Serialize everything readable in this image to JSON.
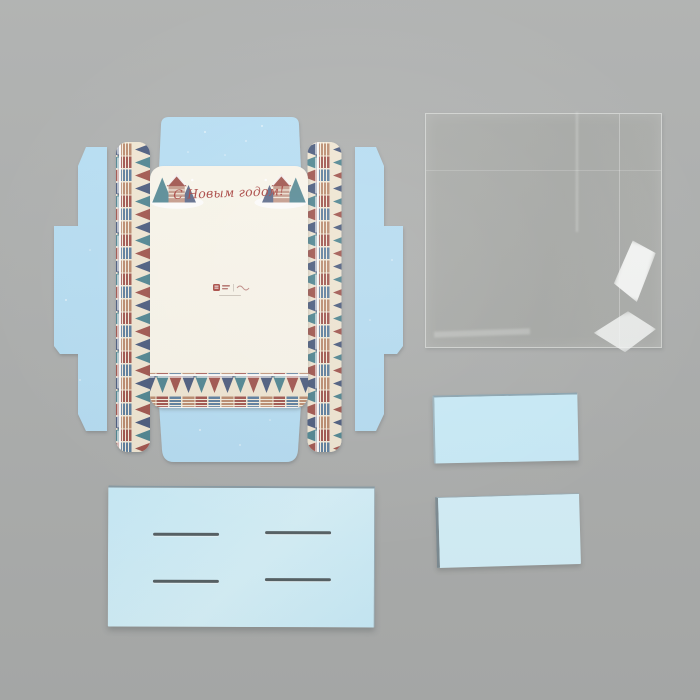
{
  "greeting": {
    "text": "С Новым годом!",
    "color": "#a8403c"
  },
  "brand_mark": {
    "icon": "brand-logo",
    "color": "#a8463f"
  },
  "palette": {
    "background": "#adafae",
    "flap_blue": "#b6def4",
    "panel_cream": "#faf6eb",
    "card_cyan": "#cbeefb",
    "card_cyan_light": "#d7f3fc",
    "pattern_cream": "#f1e7d3",
    "pattern_teal": "#4d8490",
    "pattern_red": "#a0524b",
    "pattern_navy": "#4a5a7d",
    "pattern_blue": "#5b7d9d",
    "pattern_tan": "#bb8a6d",
    "brand_red": "#a8463f",
    "greeting_red": "#a8403c"
  }
}
